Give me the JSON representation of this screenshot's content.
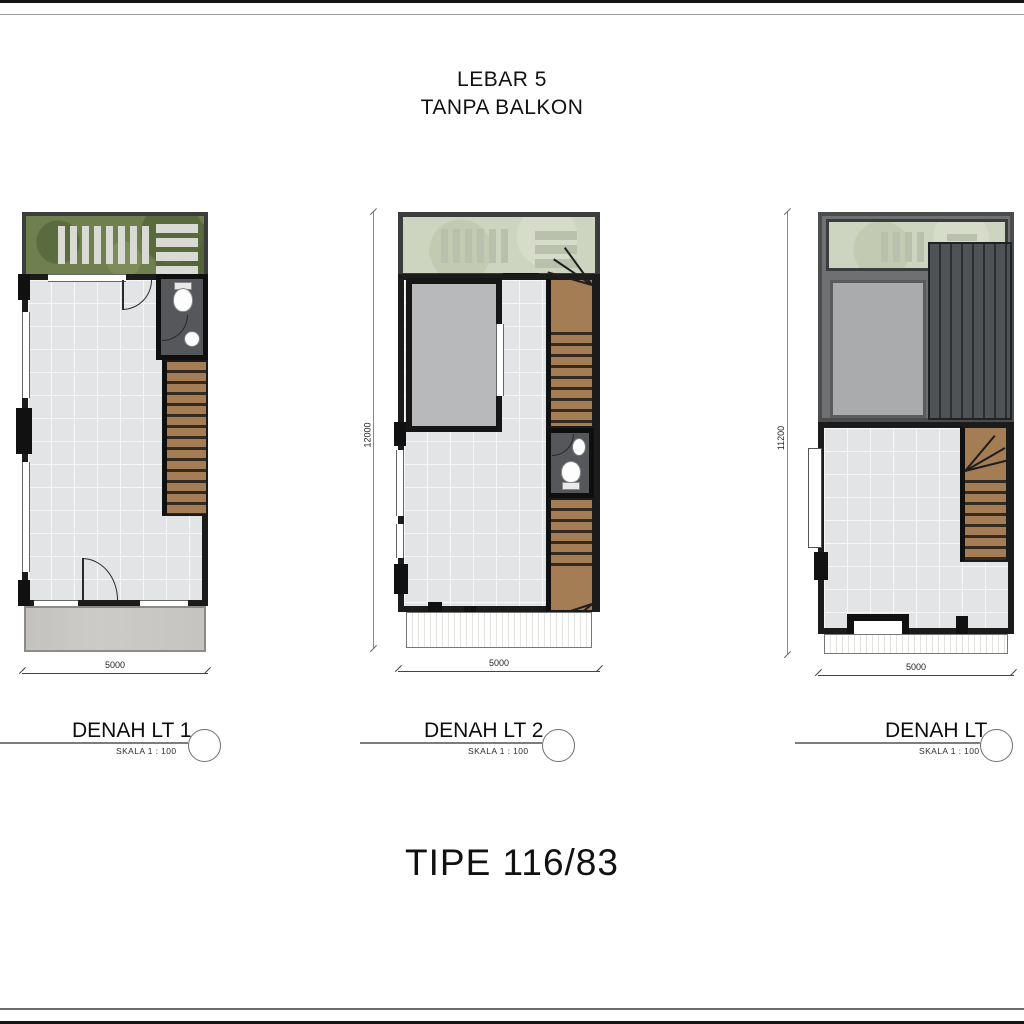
{
  "sheet": {
    "top_title_line1": "LEBAR 5",
    "top_title_line2": "TANPA BALKON",
    "bottom_title": "TIPE 116/83"
  },
  "plans": [
    {
      "label": "DENAH LT 1",
      "scale": "SKALA 1 : 100",
      "width_dim": "5000"
    },
    {
      "label": "DENAH LT 2",
      "scale": "SKALA 1 : 100",
      "width_dim": "5000",
      "height_dim": "12000"
    },
    {
      "label": "DENAH LT",
      "scale": "SKALA 1 : 100",
      "width_dim": "5000",
      "height_dim": "11200"
    }
  ],
  "colors": {
    "wall": "#1b1b1b",
    "garden_green": "#6f7f4e",
    "pale_roof_garden": "#cdd4c0",
    "tile_floor": "#e3e4e6",
    "stair_wood": "#a57d55",
    "bath_floor": "#55575a",
    "ribbed_roof": "#505356",
    "roof_deck": "#a9abac",
    "carport_concrete": "#c9c8c5"
  }
}
